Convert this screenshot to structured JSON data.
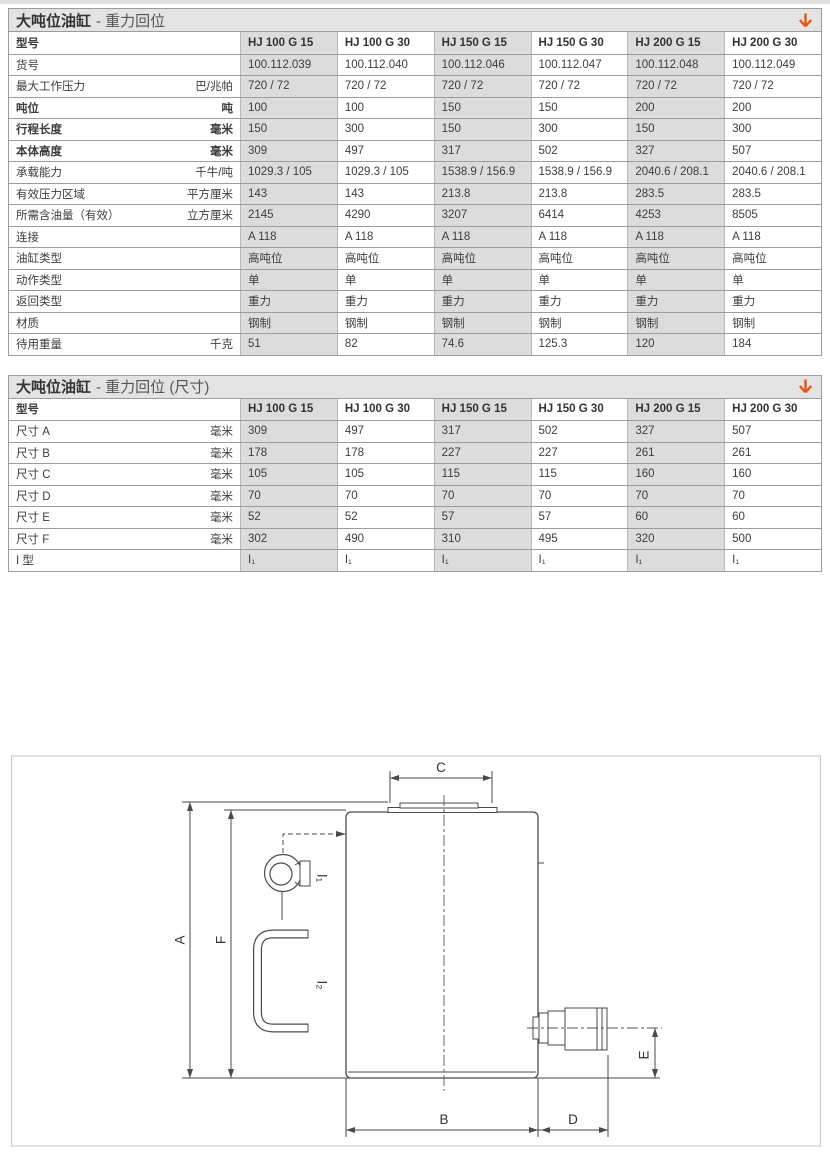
{
  "page": {
    "background": "#ffffff",
    "accent_orange": "#e8570f",
    "table_alt_column_bg": "#dcdcdc",
    "titlebar_bg": "#e3e3e3"
  },
  "icons": {
    "title_arrow": "down-arrow"
  },
  "tables": [
    {
      "title_main": "大吨位油缸",
      "title_sub": "- 重力回位",
      "header": {
        "label": "型号",
        "columns": [
          "HJ 100 G 15",
          "HJ 100 G 30",
          "HJ 150 G 15",
          "HJ 150 G 30",
          "HJ 200 G 15",
          "HJ 200 G 30"
        ]
      },
      "rows": [
        {
          "label": "货号",
          "unit": "",
          "bold": false,
          "values": [
            "100.112.039",
            "100.112.040",
            "100.112.046",
            "100.112.047",
            "100.112.048",
            "100.112.049"
          ]
        },
        {
          "label": "最大工作压力",
          "unit": "巴/兆帕",
          "bold": false,
          "values": [
            "720 / 72",
            "720 / 72",
            "720 / 72",
            "720 / 72",
            "720 / 72",
            "720 / 72"
          ]
        },
        {
          "label": "吨位",
          "unit": "吨",
          "bold": true,
          "values": [
            "100",
            "100",
            "150",
            "150",
            "200",
            "200"
          ]
        },
        {
          "label": "行程长度",
          "unit": "毫米",
          "bold": true,
          "values": [
            "150",
            "300",
            "150",
            "300",
            "150",
            "300"
          ]
        },
        {
          "label": "本体高度",
          "unit": "毫米",
          "bold": true,
          "values": [
            "309",
            "497",
            "317",
            "502",
            "327",
            "507"
          ]
        },
        {
          "label": "承载能力",
          "unit": "千牛/吨",
          "bold": false,
          "values": [
            "1029.3 / 105",
            "1029.3 / 105",
            "1538.9 / 156.9",
            "1538.9 / 156.9",
            "2040.6 / 208.1",
            "2040.6 / 208.1"
          ]
        },
        {
          "label": "有效压力区域",
          "unit": "平方厘米",
          "bold": false,
          "values": [
            "143",
            "143",
            "213.8",
            "213.8",
            "283.5",
            "283.5"
          ]
        },
        {
          "label": "所需含油量（有效）",
          "unit": "立方厘米",
          "bold": false,
          "values": [
            "2145",
            "4290",
            "3207",
            "6414",
            "4253",
            "8505"
          ]
        },
        {
          "label": "连接",
          "unit": "",
          "bold": false,
          "values": [
            "A 118",
            "A 118",
            "A 118",
            "A 118",
            "A 118",
            "A 118"
          ]
        },
        {
          "label": "油缸类型",
          "unit": "",
          "bold": false,
          "values": [
            "高吨位",
            "高吨位",
            "高吨位",
            "高吨位",
            "高吨位",
            "高吨位"
          ]
        },
        {
          "label": "动作类型",
          "unit": "",
          "bold": false,
          "values": [
            "单",
            "单",
            "单",
            "单",
            "单",
            "单"
          ]
        },
        {
          "label": "返回类型",
          "unit": "",
          "bold": false,
          "values": [
            "重力",
            "重力",
            "重力",
            "重力",
            "重力",
            "重力"
          ]
        },
        {
          "label": "材质",
          "unit": "",
          "bold": false,
          "values": [
            "钢制",
            "钢制",
            "钢制",
            "钢制",
            "钢制",
            "钢制"
          ]
        },
        {
          "label": "待用重量",
          "unit": "千克",
          "bold": false,
          "values": [
            "51",
            "82",
            "74.6",
            "125.3",
            "120",
            "184"
          ]
        }
      ]
    },
    {
      "title_main": "大吨位油缸",
      "title_sub": "- 重力回位 (尺寸)",
      "header": {
        "label": "型号",
        "columns": [
          "HJ 100 G 15",
          "HJ 100 G 30",
          "HJ 150 G 15",
          "HJ 150 G 30",
          "HJ 200 G 15",
          "HJ 200 G 30"
        ]
      },
      "rows": [
        {
          "label": "尺寸 A",
          "unit": "毫米",
          "bold": false,
          "values": [
            "309",
            "497",
            "317",
            "502",
            "327",
            "507"
          ]
        },
        {
          "label": "尺寸 B",
          "unit": "毫米",
          "bold": false,
          "values": [
            "178",
            "178",
            "227",
            "227",
            "261",
            "261"
          ]
        },
        {
          "label": "尺寸 C",
          "unit": "毫米",
          "bold": false,
          "values": [
            "105",
            "105",
            "115",
            "115",
            "160",
            "160"
          ]
        },
        {
          "label": "尺寸 D",
          "unit": "毫米",
          "bold": false,
          "values": [
            "70",
            "70",
            "70",
            "70",
            "70",
            "70"
          ]
        },
        {
          "label": "尺寸 E",
          "unit": "毫米",
          "bold": false,
          "values": [
            "52",
            "52",
            "57",
            "57",
            "60",
            "60"
          ]
        },
        {
          "label": "尺寸 F",
          "unit": "毫米",
          "bold": false,
          "values": [
            "302",
            "490",
            "310",
            "495",
            "320",
            "500"
          ]
        },
        {
          "label": "I 型",
          "unit": "",
          "bold": false,
          "values": [
            "I₁",
            "I₁",
            "I₁",
            "I₁",
            "I₁",
            "I₁"
          ]
        }
      ]
    }
  ],
  "diagram": {
    "labels": {
      "A": "A",
      "B": "B",
      "C": "C",
      "D": "D",
      "E": "E",
      "F": "F",
      "I1": "I₁",
      "I2": "I₂"
    }
  }
}
